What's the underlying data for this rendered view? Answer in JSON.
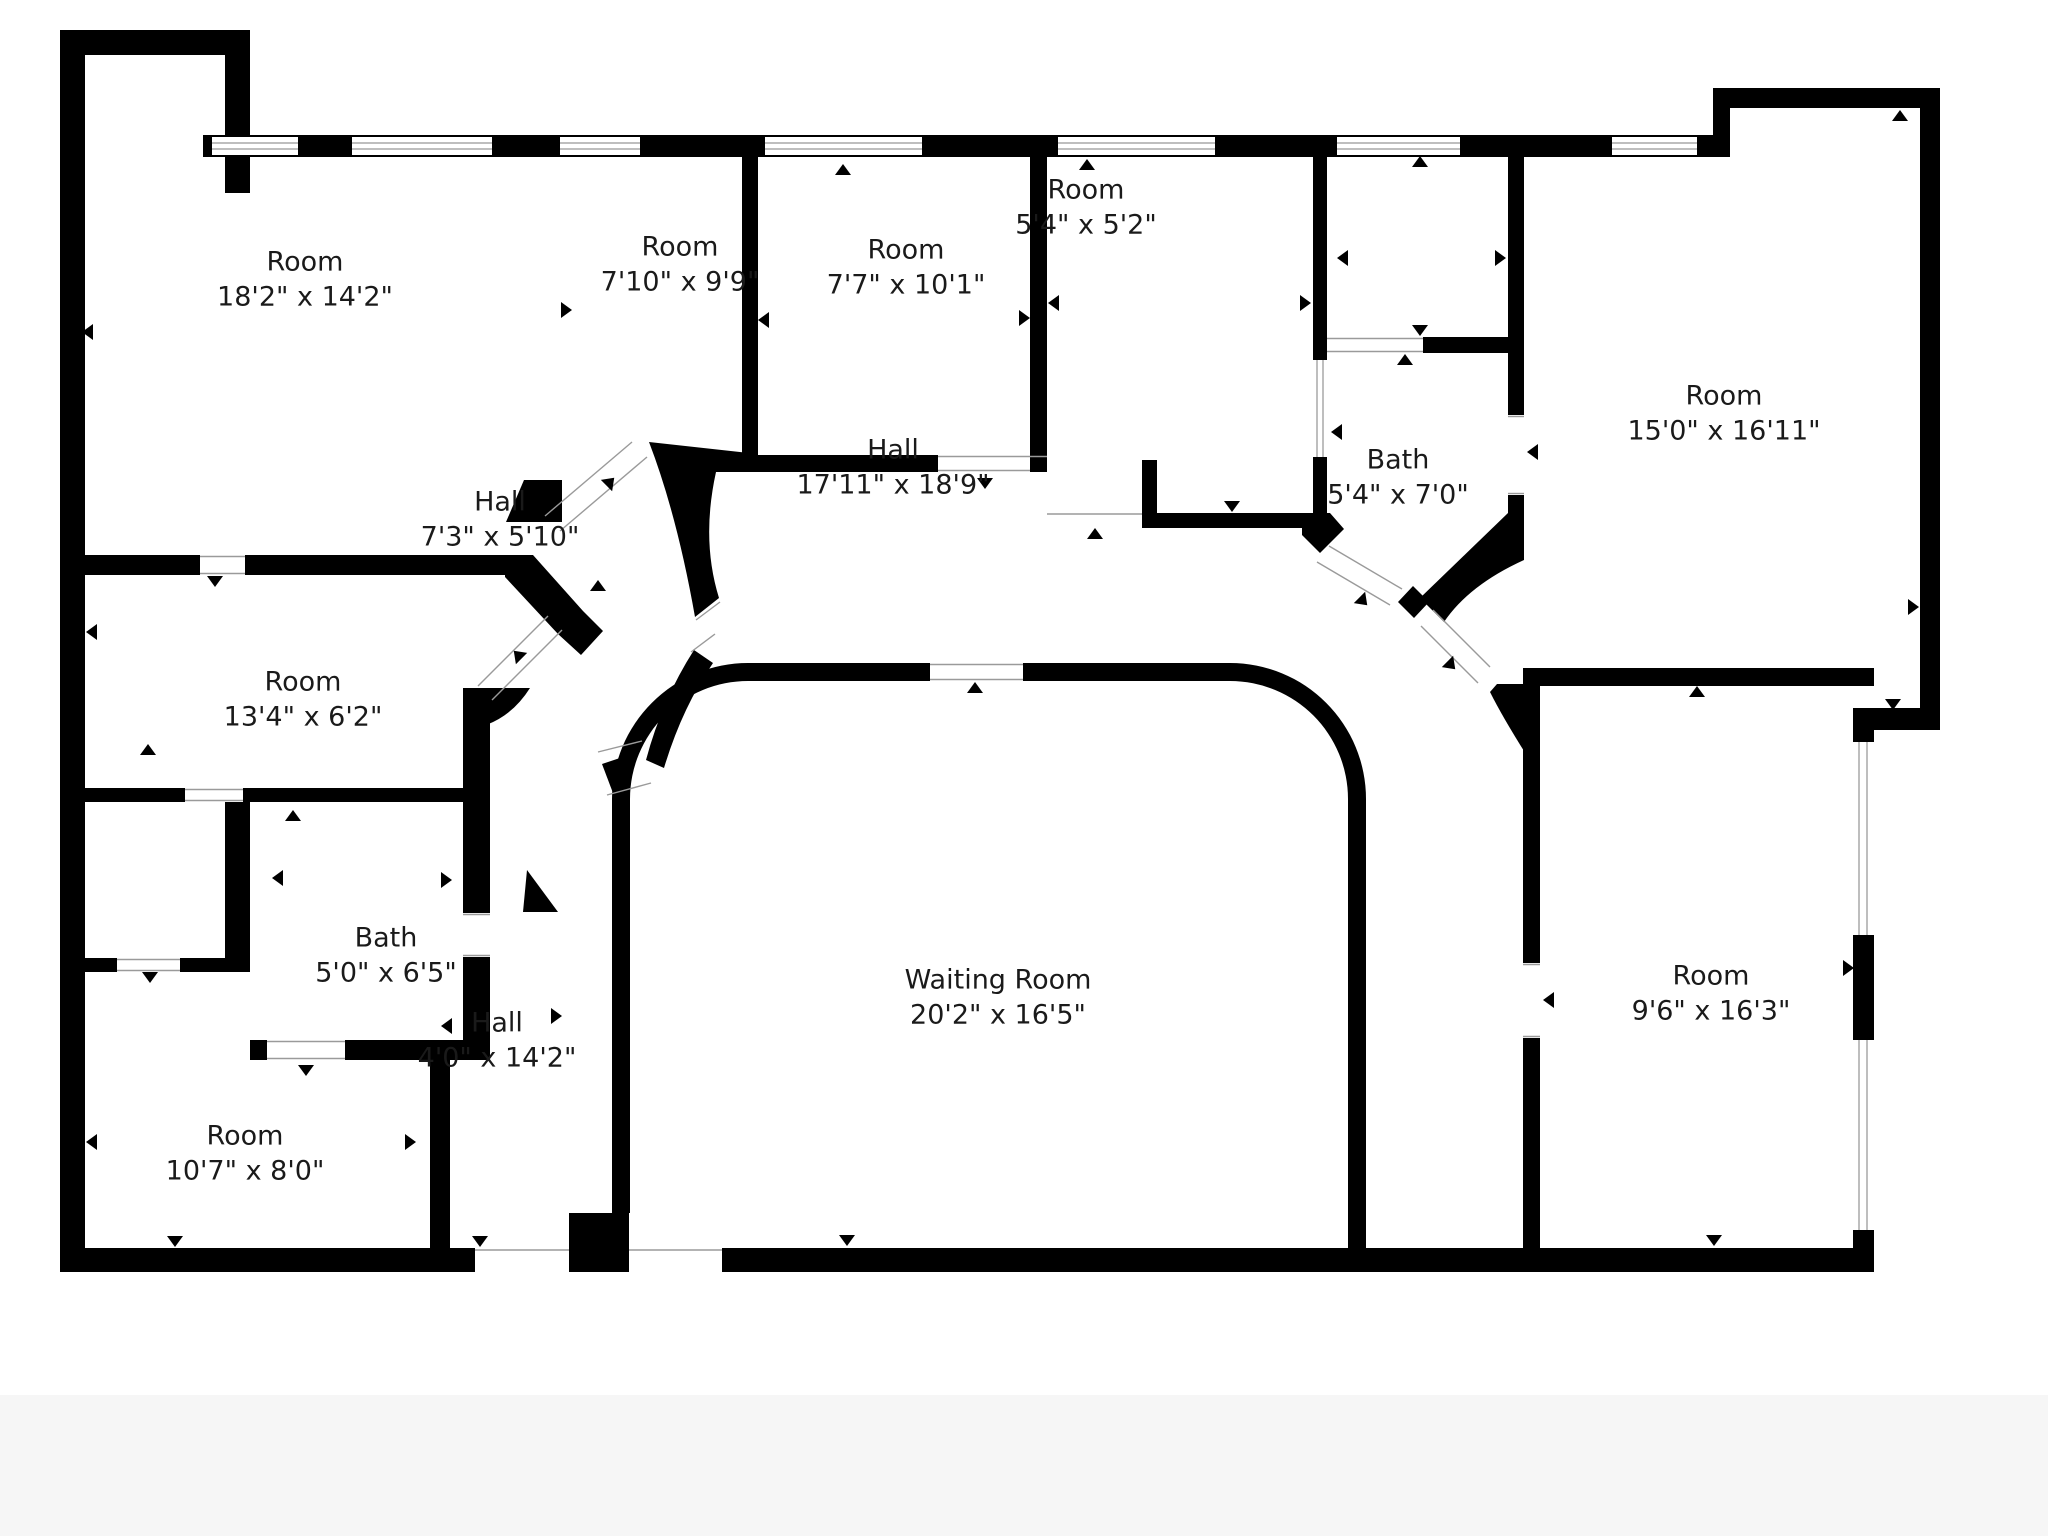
{
  "title": "Floor plan",
  "colors": {
    "wall": "#000000",
    "background": "#ffffff",
    "window_line": "#a8a8a8",
    "door_line": "#9a9a9a",
    "text": "#1a1a1a"
  },
  "rooms": [
    {
      "name": "Room",
      "dims": "18'2\" x 14'2\""
    },
    {
      "name": "Room",
      "dims": "7'10\" x 9'9\""
    },
    {
      "name": "Room",
      "dims": "7'7\" x 10'1\""
    },
    {
      "name": "Room",
      "dims": "5'4\" x 5'2\""
    },
    {
      "name": "Bath",
      "dims": "5'4\" x 7'0\""
    },
    {
      "name": "Room",
      "dims": "15'0\" x 16'11\""
    },
    {
      "name": "Hall",
      "dims": "17'11\" x 18'9\""
    },
    {
      "name": "Hall",
      "dims": "7'3\" x 5'10\""
    },
    {
      "name": "Room",
      "dims": "13'4\" x 6'2\""
    },
    {
      "name": "Bath",
      "dims": "5'0\" x 6'5\""
    },
    {
      "name": "Hall",
      "dims": "4'0\" x 14'2\""
    },
    {
      "name": "Room",
      "dims": "10'7\" x 8'0\""
    },
    {
      "name": "Waiting Room",
      "dims": "20'2\" x 16'5\""
    },
    {
      "name": "Room",
      "dims": "9'6\" x 16'3\""
    }
  ]
}
